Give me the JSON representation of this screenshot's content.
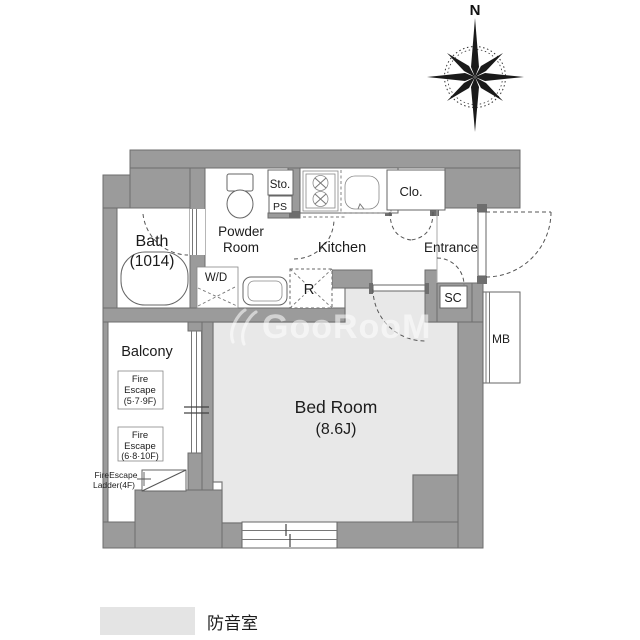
{
  "colors": {
    "wall": "#9b9b9b",
    "wall-line": "#6e6e6e",
    "line": "#555555",
    "soundproof": "#e8e8e8",
    "text": "#1c1c1c",
    "watermark": "#ffffff"
  },
  "compass": {
    "north": "N"
  },
  "rooms": {
    "bath": {
      "name": "Bath",
      "size": "(1014)"
    },
    "powder_room": {
      "name_line1": "Powder",
      "name_line2": "Room"
    },
    "kitchen": {
      "name": "Kitchen"
    },
    "entrance": {
      "name": "Entrance"
    },
    "closet": {
      "name": "Clo."
    },
    "bed_room": {
      "name": "Bed Room",
      "size": "(8.6J)"
    },
    "balcony": {
      "name": "Balcony"
    }
  },
  "compartments": {
    "storage": "Sto.",
    "pipe_space": "PS",
    "washer_dryer": "W/D",
    "refrigerator": "R",
    "shoe_closet": "SC",
    "meter_box": "MB"
  },
  "annotations": {
    "fire_escape_upper": {
      "line1": "Fire",
      "line2": "Escape",
      "line3": "(5·7·9F)"
    },
    "fire_escape_lower": {
      "line1": "Fire",
      "line2": "Escape",
      "line3": "(6·8·10F)"
    },
    "fire_escape_ladder": {
      "line1": "FireEscape",
      "line2": "Ladder(4F)"
    }
  },
  "legend": {
    "soundproof_label": "防音室"
  },
  "watermark": {
    "text": "GooRooM"
  }
}
